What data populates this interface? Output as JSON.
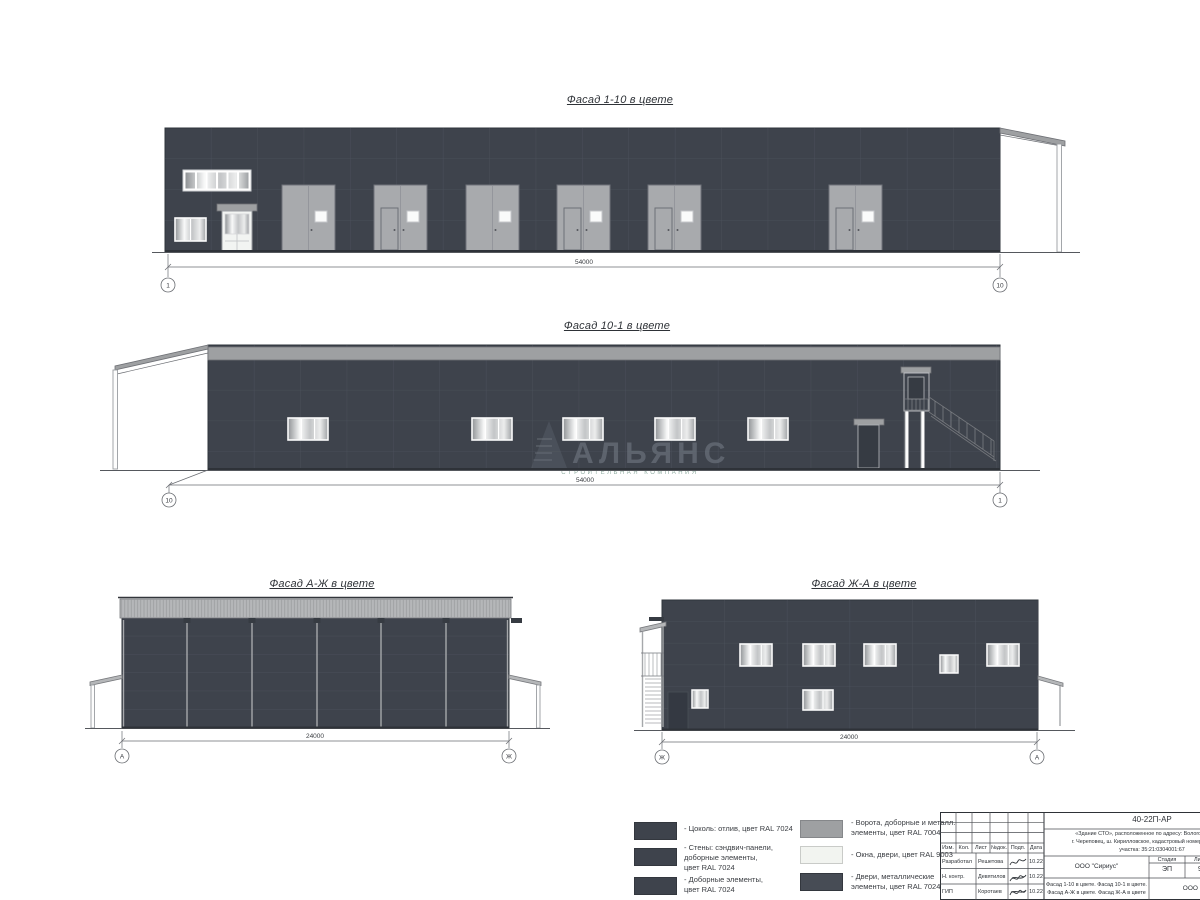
{
  "colors": {
    "wall": "#3E434C",
    "seam": "#4C525C",
    "metal": "#9EA0A2",
    "gate": "#A8AAAD",
    "band-light": "#B5B7B9",
    "legend-offwhite": "#F2F4F0",
    "dark-element": "#363B42"
  },
  "facades": {
    "f1": {
      "title": "Фасад 1-10 в цвете",
      "dim": "54000",
      "axis_left": "1",
      "axis_right": "10"
    },
    "f2": {
      "title": "Фасад 10-1 в цвете",
      "dim": "54000",
      "axis_left": "10",
      "axis_right": "1"
    },
    "f3": {
      "title": "Фасад А-Ж в цвете",
      "dim": "24000",
      "axis_left": "А",
      "axis_right": "Ж"
    },
    "f4": {
      "title": "Фасад Ж-А в цвете",
      "dim": "24000",
      "axis_left": "Ж",
      "axis_right": "А"
    }
  },
  "watermark": {
    "name": "АЛЬЯНС",
    "subtitle": "СТРОИТЕЛЬНАЯ КОМПАНИЯ"
  },
  "legend": {
    "left": [
      {
        "label": "- Цоколь: отлив, цвет RAL 7024"
      },
      {
        "label": "- Стены: сэндвич-панели,\nдоборные элементы,\nцвет RAL 7024"
      },
      {
        "label": "- Доборные элементы,\nцвет RAL 7024"
      }
    ],
    "right": [
      {
        "label": "- Ворота, доборные и металл.\nэлементы, цвет RAL 7004"
      },
      {
        "label": "- Окна, двери, цвет RAL 9003"
      },
      {
        "label": "- Двери, металлические\nэлементы, цвет RAL 7024"
      }
    ]
  },
  "titleblock": {
    "doc_number": "40-22П-АР",
    "project_desc": "«Здание СТО», расположенное по адресу: Вологодская обл.,\nг. Череповец, ш. Кирилловское, кадастровый номер земельного\nучастка: 35:21:0304001:67",
    "cols": [
      "Изм.",
      "Кол.",
      "Лист",
      "№док.",
      "Подп.",
      "Дата"
    ],
    "rows": [
      {
        "role": "Разработал",
        "name": "Решетова",
        "date": "10.22"
      },
      {
        "role": "Н. контр.",
        "name": "Девятилов",
        "date": "10.22"
      },
      {
        "role": "ГИП",
        "name": "Коротаев",
        "date": "10.22"
      }
    ],
    "org1": "ООО \"Сириус\"",
    "stage_label": "Стадия",
    "sheet_label": "Лист",
    "sheets_label": "Листов",
    "stage": "ЭП",
    "sheet": "9",
    "sheet_title": "Фасад 1-10 в цвете. Фасад 10-1 в цвете.\nФасад А-Ж в цвете. Фасад Ж-А в цвете",
    "org2": "ООО \"Альянс\""
  }
}
